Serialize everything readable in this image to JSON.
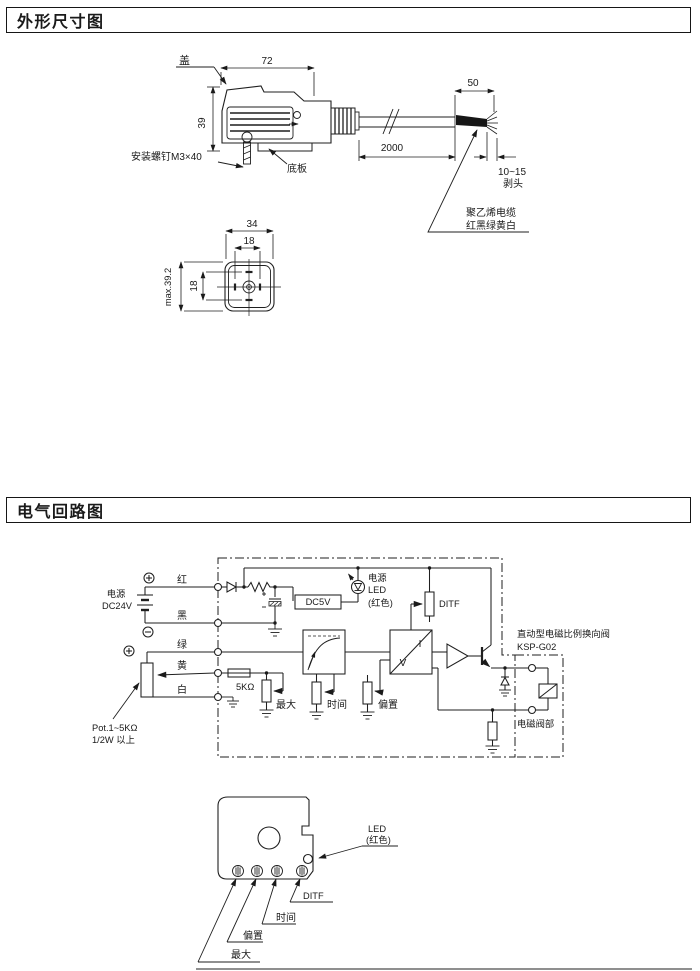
{
  "page": {
    "title1": "外形尺寸图",
    "title2": "电气回路图"
  },
  "outline": {
    "cover": "盖",
    "dim72": "72",
    "dim39": "39",
    "screw": "安装螺钉M3×40",
    "base": "底板",
    "dim2000": "2000",
    "dim50": "50",
    "dim10_15": "10~15",
    "strip": "剥头",
    "cable_line1": "聚乙烯电缆",
    "cable_line2": "红黑绿黄白",
    "dim34": "34",
    "dim18_top": "18",
    "dim18_left": "18",
    "dim_max": "max.39.2"
  },
  "circuit": {
    "power_line1": "电源",
    "power_line2": "DC24V",
    "wire_red": "红",
    "wire_black": "黑",
    "wire_green": "绿",
    "wire_yellow": "黄",
    "wire_white": "白",
    "pot_line1": "Pot.1~5KΩ",
    "pot_line2": "1/2W 以上",
    "r5k": "5KΩ",
    "pot_max": "最大",
    "dc5v": "DC5V",
    "led_line1": "电源",
    "led_line2": "LED",
    "led_line3": "(红色)",
    "ditf": "DITF",
    "pot_time": "时间",
    "pot_offset": "偏置",
    "iv_i": "I",
    "iv_v": "V",
    "valve_line1": "直动型电磁比例换向阀",
    "valve_line2": "KSP-G02",
    "solenoid_part": "电磁阀部"
  },
  "panel": {
    "led_line1": "LED",
    "led_line2": "(红色)",
    "knob_ditf": "DITF",
    "knob_time": "时间",
    "knob_offset": "偏置",
    "knob_max": "最大"
  }
}
